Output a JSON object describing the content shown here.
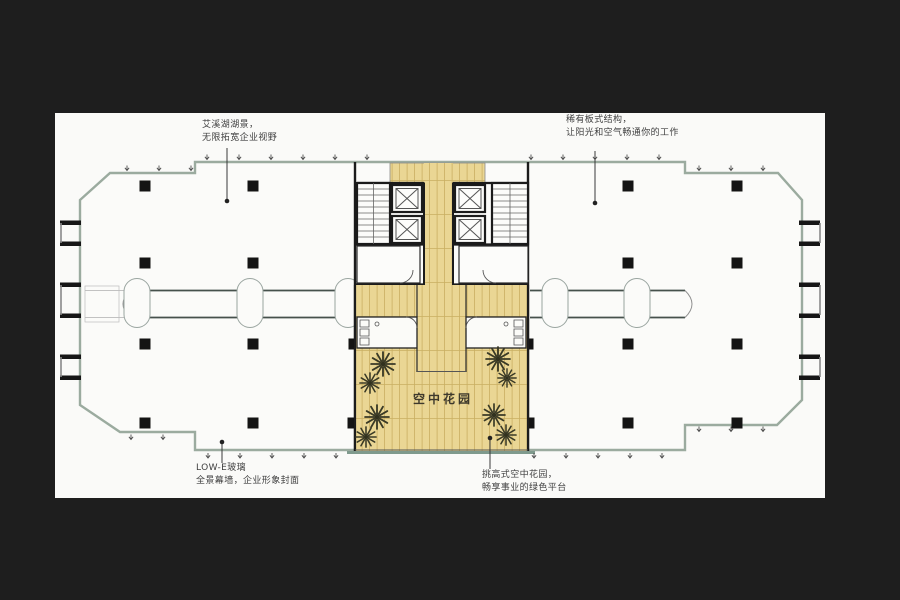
{
  "canvas": {
    "background": "#1e1e1e",
    "paper": "#fafaf8"
  },
  "floorplan": {
    "garden_label": "空中花园",
    "annotations": {
      "top_left": {
        "line1": "艾溪湖湖景，",
        "line2": "无限拓宽企业视野"
      },
      "top_right": {
        "line1": "稀有板式结构，",
        "line2": "让阳光和空气畅通你的工作"
      },
      "bottom_left": {
        "line1": "LOW-E玻璃",
        "line2": "全景幕墙，企业形象封面"
      },
      "bottom_right": {
        "line1": "挑高式空中花园，",
        "line2": "畅享事业的绿色平台"
      }
    },
    "colors": {
      "garden_floor": "#ead694",
      "plank_line": "#c9af62",
      "facade_line": "#9bab9f",
      "wall": "#1b1b1b",
      "column": "#141414",
      "plant": "#3a3a26",
      "garden_edge": "#7f9a8d"
    }
  }
}
